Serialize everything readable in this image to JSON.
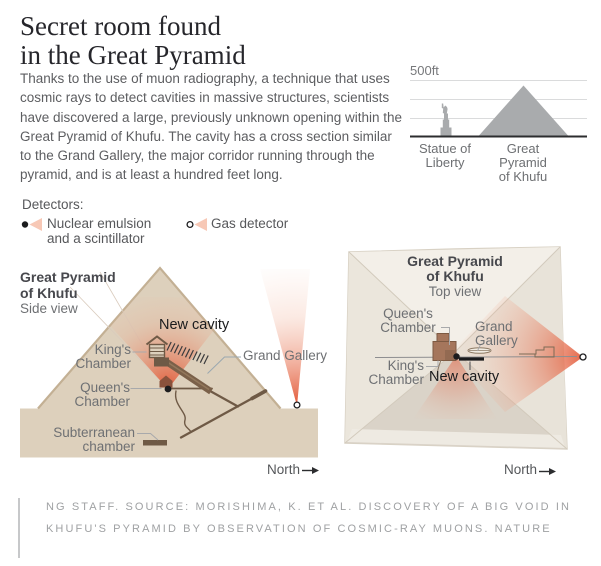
{
  "header": {
    "title": "Secret room found\nin the Great Pyramid",
    "intro": "Thanks to the use of muon radiography, a technique that uses cosmic rays to detect cavities in massive structures, scientists have discovered a large, previously unknown opening within the Great Pyramid of Khufu. The cavity has a cross section similar to the Grand Gallery, the major corridor running through the pyramid, and is at least a hundred feet long."
  },
  "chart_data": {
    "type": "bar",
    "title": "Height comparison",
    "axis_top_label": "500ft",
    "ylim": [
      0,
      500
    ],
    "gridlines_ft": [
      500,
      333,
      167
    ],
    "categories": [
      "Statue of Liberty",
      "Great Pyramid of Khufu"
    ],
    "values": [
      305,
      481
    ],
    "labels": {
      "statue": "Statue of\nLiberty",
      "pyramid": "Great\nPyramid\nof Khufu"
    }
  },
  "legend": {
    "title": "Detectors:",
    "items": [
      {
        "marker": "filled-dot-beam",
        "label": "Nuclear emulsion\nand a scintillator"
      },
      {
        "marker": "open-dot-beam",
        "label": "Gas detector"
      }
    ]
  },
  "side_view": {
    "title": "Great Pyramid\nof Khufu",
    "subtitle": "Side view",
    "labels": {
      "new_cavity": "New cavity",
      "kings_chamber": "King's\nChamber",
      "queens_chamber": "Queen's\nChamber",
      "grand_gallery": "Grand Gallery",
      "subterranean": "Subterranean\nchamber",
      "north": "North"
    }
  },
  "top_view": {
    "title": "Great Pyramid\nof Khufu",
    "subtitle": "Top view",
    "labels": {
      "queens_chamber": "Queen's\nChamber",
      "grand_gallery": "Grand\nGallery",
      "kings_chamber": "King's\nChamber",
      "new_cavity": "New cavity",
      "north": "North"
    }
  },
  "source": {
    "credit": "NG STAFF. SOURCE: MORISHIMA, K. ET AL. DISCOVERY OF A BIG VOID IN KHUFU'S PYRAMID BY OBSERVATION OF COSMIC-RAY MUONS. NATURE"
  },
  "colors": {
    "beam": "#e14f2c",
    "sand": "#ddd0bc",
    "passage": "#6f5a46",
    "silhouette": "#a9abad",
    "legend_wedge": "#f7c8b6"
  }
}
